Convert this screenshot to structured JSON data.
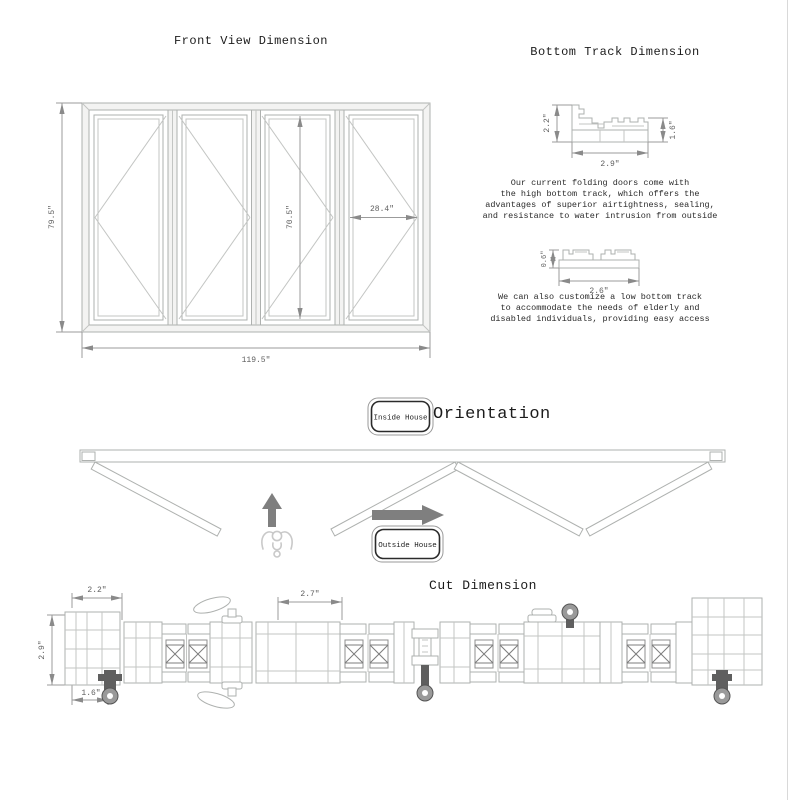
{
  "front_view": {
    "title": "Front View Dimension",
    "dim_height": "79.5\"",
    "dim_width": "119.5\"",
    "dim_leaf_height": "70.5\"",
    "dim_leaf_width": "28.4\""
  },
  "bottom_track": {
    "title": "Bottom Track Dimension",
    "high_track": {
      "height_left": "2.2\"",
      "height_right": "1.6\"",
      "width": "2.9\""
    },
    "high_note": [
      "Our current folding doors come with",
      "the high bottom track, which offers the",
      "advantages of superior airtightness, sealing,",
      "and resistance to water intrusion from outside"
    ],
    "low_track": {
      "height": "0.6\"",
      "width": "2.6\""
    },
    "low_note": [
      "We can also customize a low bottom track",
      "to accommodate the needs of elderly and",
      "disabled individuals, providing easy access"
    ]
  },
  "orientation": {
    "title": "Orientation",
    "inside_label": "Inside House",
    "outside_label": "Outside House"
  },
  "cut": {
    "title": "Cut Dimension",
    "dim_top_left": "2.2\"",
    "dim_left": "2.9\"",
    "dim_bottom_left": "1.6\"",
    "dim_top_mid": "2.7\""
  },
  "colors": {
    "profile_line": "#aeb1af",
    "dim_line": "#9b9b9b",
    "dim_text": "#5f5f5f",
    "arrow_fill": "#7f7f7f",
    "title_text": "#1c1c1c"
  }
}
